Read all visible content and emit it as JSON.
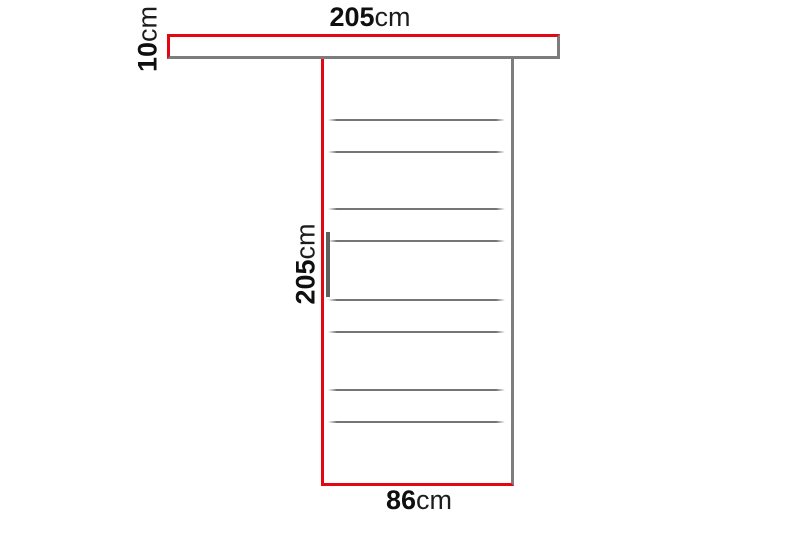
{
  "diagram": {
    "colors": {
      "dimension_highlight_red": "#e30613",
      "outline_gray": "#7d7d7d",
      "slat_line_gray": "#757575",
      "handle_gray": "#5f5f5f",
      "label_text": "#0f0f0f"
    },
    "labels": {
      "rail_width": {
        "value": "205",
        "unit": "cm"
      },
      "rail_height": {
        "value": "10",
        "unit": "cm"
      },
      "door_height": {
        "value": "205",
        "unit": "cm"
      },
      "door_width": {
        "value": "86",
        "unit": "cm"
      }
    },
    "door": {
      "slat_line_offsets_px": [
        60,
        92,
        149,
        181,
        240,
        272,
        330,
        362
      ]
    }
  }
}
